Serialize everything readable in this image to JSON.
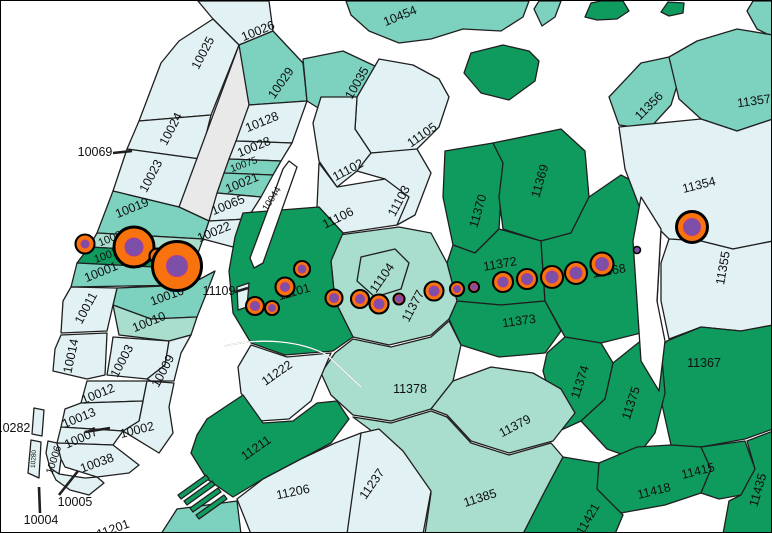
{
  "map": {
    "description": "NYC zip-code choropleth with proportional station symbols along the 7 line from Midtown Manhattan to Flushing",
    "colors": {
      "water": "#ffffff",
      "class_palest": "#e2f2f4",
      "class_light": "#a9ddcd",
      "class_medium": "#7cd2bf",
      "class_dark": "#0f9b5e",
      "park_gray": "#e9e9e9",
      "boundary": "#1f1f1f",
      "symbol_orange": "#f8730d",
      "symbol_stroke": "#000000",
      "symbol_purple": "#7c4fa8",
      "symbol_purple_stroke": "#b13c96"
    },
    "labels": [
      {
        "text": "10026",
        "x": 257,
        "y": 30,
        "rot": -22
      },
      {
        "text": "10025",
        "x": 202,
        "y": 52,
        "rot": -62
      },
      {
        "text": "10024",
        "x": 170,
        "y": 128,
        "rot": -62
      },
      {
        "text": "10023",
        "x": 150,
        "y": 175,
        "rot": -62
      },
      {
        "text": "10069",
        "x": 94,
        "y": 151,
        "rot": 0
      },
      {
        "text": "10029",
        "x": 280,
        "y": 82,
        "rot": -55
      },
      {
        "text": "10035",
        "x": 356,
        "y": 82,
        "rot": -60
      },
      {
        "text": "10128",
        "x": 261,
        "y": 121,
        "rot": -22
      },
      {
        "text": "10028",
        "x": 253,
        "y": 146,
        "rot": -22
      },
      {
        "text": "10075",
        "x": 243,
        "y": 164,
        "rot": -20,
        "size": 10
      },
      {
        "text": "10021",
        "x": 241,
        "y": 182,
        "rot": -22
      },
      {
        "text": "10065",
        "x": 227,
        "y": 204,
        "rot": -22
      },
      {
        "text": "10019",
        "x": 131,
        "y": 207,
        "rot": -22
      },
      {
        "text": "10022",
        "x": 213,
        "y": 231,
        "rot": -22
      },
      {
        "text": "10036",
        "x": 112,
        "y": 237,
        "rot": -22,
        "size": 11
      },
      {
        "text": "10018",
        "x": 108,
        "y": 254,
        "rot": -20,
        "size": 11
      },
      {
        "text": "10001",
        "x": 100,
        "y": 271,
        "rot": -22
      },
      {
        "text": "10016",
        "x": 166,
        "y": 295,
        "rot": -20
      },
      {
        "text": "10011",
        "x": 85,
        "y": 307,
        "rot": -62
      },
      {
        "text": "10010",
        "x": 148,
        "y": 321,
        "rot": -22
      },
      {
        "text": "10014",
        "x": 70,
        "y": 355,
        "rot": -78
      },
      {
        "text": "10003",
        "x": 121,
        "y": 360,
        "rot": -62
      },
      {
        "text": "10009",
        "x": 162,
        "y": 370,
        "rot": -62
      },
      {
        "text": "10012",
        "x": 97,
        "y": 393,
        "rot": -22
      },
      {
        "text": "10013",
        "x": 78,
        "y": 417,
        "rot": -22
      },
      {
        "text": "10002",
        "x": 136,
        "y": 429,
        "rot": -14
      },
      {
        "text": "10007",
        "x": 80,
        "y": 437,
        "rot": -24
      },
      {
        "text": "10006",
        "x": 53,
        "y": 459,
        "rot": -72,
        "size": 10.5
      },
      {
        "text": "10280",
        "x": 33,
        "y": 458,
        "rot": -86,
        "size": 6.5
      },
      {
        "text": "10038",
        "x": 96,
        "y": 462,
        "rot": -20
      },
      {
        "text": "10282",
        "x": 12,
        "y": 427,
        "rot": 0
      },
      {
        "text": "10005",
        "x": 74,
        "y": 501,
        "rot": 0
      },
      {
        "text": "10004",
        "x": 40,
        "y": 519,
        "rot": 0
      },
      {
        "text": "11201",
        "x": 112,
        "y": 528,
        "rot": -20
      },
      {
        "text": "10044",
        "x": 271,
        "y": 198,
        "rot": -58,
        "size": 9.5
      },
      {
        "text": "11109",
        "x": 218,
        "y": 290,
        "rot": 0
      },
      {
        "text": "10454",
        "x": 399,
        "y": 15,
        "rot": -22
      },
      {
        "text": "11105",
        "x": 421,
        "y": 134,
        "rot": -35
      },
      {
        "text": "11102",
        "x": 347,
        "y": 169,
        "rot": -28
      },
      {
        "text": "11106",
        "x": 337,
        "y": 217,
        "rot": -26
      },
      {
        "text": "11103",
        "x": 398,
        "y": 200,
        "rot": -62
      },
      {
        "text": "11101",
        "x": 293,
        "y": 291,
        "rot": -16
      },
      {
        "text": "11104",
        "x": 381,
        "y": 277,
        "rot": -55
      },
      {
        "text": "11377",
        "x": 412,
        "y": 305,
        "rot": -62
      },
      {
        "text": "11370",
        "x": 477,
        "y": 210,
        "rot": -74
      },
      {
        "text": "11369",
        "x": 539,
        "y": 180,
        "rot": -74
      },
      {
        "text": "11372",
        "x": 499,
        "y": 263,
        "rot": -10
      },
      {
        "text": "11368",
        "x": 608,
        "y": 270,
        "rot": -10
      },
      {
        "text": "11373",
        "x": 518,
        "y": 320,
        "rot": -8
      },
      {
        "text": "11354",
        "x": 698,
        "y": 184,
        "rot": -14
      },
      {
        "text": "11355",
        "x": 722,
        "y": 267,
        "rot": -80
      },
      {
        "text": "11356",
        "x": 648,
        "y": 105,
        "rot": -45
      },
      {
        "text": "11357",
        "x": 753,
        "y": 100,
        "rot": -8
      },
      {
        "text": "11367",
        "x": 703,
        "y": 362,
        "rot": 0
      },
      {
        "text": "11374",
        "x": 579,
        "y": 381,
        "rot": -72
      },
      {
        "text": "11375",
        "x": 630,
        "y": 402,
        "rot": -72
      },
      {
        "text": "11378",
        "x": 409,
        "y": 388,
        "rot": 0
      },
      {
        "text": "11379",
        "x": 514,
        "y": 425,
        "rot": -28
      },
      {
        "text": "11385",
        "x": 479,
        "y": 497,
        "rot": -18
      },
      {
        "text": "11415",
        "x": 697,
        "y": 470,
        "rot": -14
      },
      {
        "text": "11418",
        "x": 653,
        "y": 490,
        "rot": -14
      },
      {
        "text": "11435",
        "x": 757,
        "y": 489,
        "rot": -74
      },
      {
        "text": "11421",
        "x": 587,
        "y": 518,
        "rot": -60
      },
      {
        "text": "11222",
        "x": 276,
        "y": 372,
        "rot": -35
      },
      {
        "text": "11211",
        "x": 255,
        "y": 447,
        "rot": -35
      },
      {
        "text": "11206",
        "x": 292,
        "y": 491,
        "rot": -12
      },
      {
        "text": "11237",
        "x": 371,
        "y": 483,
        "rot": -55
      }
    ],
    "leader_lines": [
      {
        "zip": "10069",
        "x1": 112,
        "y1": 152,
        "x2": 131,
        "y2": 150
      },
      {
        "zip": "11109",
        "x1": 234,
        "y1": 291,
        "x2": 247,
        "y2": 287
      },
      {
        "zip": "10282",
        "x1": 84,
        "y1": 431,
        "x2": 109,
        "y2": 427
      },
      {
        "zip": "10005",
        "x1": 58,
        "y1": 494,
        "x2": 77,
        "y2": 470
      },
      {
        "zip": "10004",
        "x1": 39,
        "y1": 512,
        "x2": 38,
        "y2": 486
      }
    ],
    "station_symbols": [
      {
        "x": 84,
        "y": 243,
        "orange_r": 9.5,
        "purple_r": 4
      },
      {
        "x": 133,
        "y": 246,
        "orange_r": 20,
        "purple_r": 9
      },
      {
        "x": 156,
        "y": 255,
        "orange_r": 7.5,
        "purple_r": 3
      },
      {
        "x": 176,
        "y": 265,
        "orange_r": 24.5,
        "purple_r": 10.5
      },
      {
        "x": 301,
        "y": 268,
        "orange_r": 8,
        "purple_r": 4
      },
      {
        "x": 284,
        "y": 286,
        "orange_r": 9.5,
        "purple_r": 4.5
      },
      {
        "x": 254,
        "y": 305,
        "orange_r": 9,
        "purple_r": 4.5
      },
      {
        "x": 271,
        "y": 307,
        "orange_r": 7,
        "purple_r": 3.5
      },
      {
        "x": 333,
        "y": 297,
        "orange_r": 8.5,
        "purple_r": 4.5
      },
      {
        "x": 359,
        "y": 298,
        "orange_r": 9,
        "purple_r": 4.5
      },
      {
        "x": 378,
        "y": 303,
        "orange_r": 9.5,
        "purple_r": 5
      },
      {
        "x": 398,
        "y": 298,
        "orange_r": 5.5,
        "purple_r": 3.5
      },
      {
        "x": 433,
        "y": 290,
        "orange_r": 9.5,
        "purple_r": 5
      },
      {
        "x": 456,
        "y": 288,
        "orange_r": 7,
        "purple_r": 3.5
      },
      {
        "x": 473,
        "y": 286,
        "orange_r": 5,
        "purple_r": 3
      },
      {
        "x": 502,
        "y": 281,
        "orange_r": 10,
        "purple_r": 5
      },
      {
        "x": 526,
        "y": 278,
        "orange_r": 10,
        "purple_r": 5.5
      },
      {
        "x": 551,
        "y": 276,
        "orange_r": 11,
        "purple_r": 6
      },
      {
        "x": 575,
        "y": 272,
        "orange_r": 11,
        "purple_r": 6
      },
      {
        "x": 601,
        "y": 263,
        "orange_r": 11.5,
        "purple_r": 6.5
      },
      {
        "x": 636,
        "y": 249,
        "orange_r": 0,
        "purple_r": 3.5
      },
      {
        "x": 691,
        "y": 226,
        "orange_r": 15.5,
        "purple_r": 8.5
      }
    ]
  }
}
